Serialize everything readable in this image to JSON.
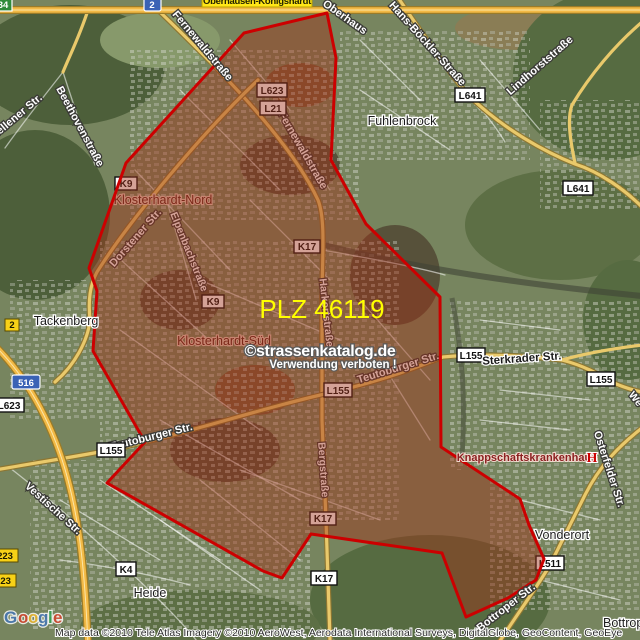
{
  "map": {
    "overlay": {
      "plz_label": "PLZ 46119",
      "watermark_line1": "©strassenkatalog.de",
      "watermark_line2": "Verwendung verboten !"
    },
    "places": {
      "oberhausen_koenigshardt": "Oberhausen-Königshardt",
      "fuhlenbrock": "Fuhlenbrock",
      "klosterhardt_nord": "Klosterhardt-Nord",
      "klosterhardt_sued": "Klosterhardt-Süd",
      "tackenberg": "Tackenberg",
      "heide": "Heide",
      "vonderort": "Vonderort",
      "bottrop": "Bottrop",
      "knappschaftskrankenhaus": "Knappschaftskrankenhaus",
      "hospital_symbol": "H"
    },
    "streets": {
      "fernewaldstrasse": "Fernewaldstraße",
      "beethovenstrasse": "Beethovenstraße",
      "kirchhellener": "Kirchhellener Str.",
      "hans_boeckler": "Hans-Böckler-Straße",
      "lindhorststrasse": "Lindhorststraße",
      "oberhaus_partial": "Oberhaus",
      "dorstener": "Dorstener Str.",
      "elpenbachstrasse": "Elpenbachstraße",
      "harkortstrasse": "Harkortstraße",
      "teutoburger": "Teutoburger Str.",
      "bergstrasse": "Bergstraße",
      "sterkrader": "Sterkrader Str.",
      "osterfelder": "Osterfelder Str.",
      "vestische": "Vestische Str.",
      "bottroper": "Bottroper Str.",
      "we_partial": "We"
    },
    "route_shields": {
      "a2": "2",
      "a516": "516",
      "e34": "34",
      "b2": "2",
      "b223": "223",
      "l641": "L641",
      "l623": "L623",
      "l21": "L21",
      "l155": "L155",
      "l511": "L511",
      "k9": "K9",
      "k17": "K17",
      "k4": "K4"
    },
    "colors": {
      "zone_fill": "#a03018",
      "zone_border": "#cc0000",
      "plz_text": "#ffff00",
      "road_yellow": "#e9c96b",
      "label_yellow_bg": "#ffe617"
    }
  },
  "attribution": {
    "logo_letters": [
      "G",
      "o",
      "o",
      "g",
      "l",
      "e"
    ],
    "copyright": "Map data ©2010 Tele Atlas  Imagery ©2010 AeroWest, Aerodata International Surveys, DigitalGlobe, GeoContent, GeoEye"
  }
}
